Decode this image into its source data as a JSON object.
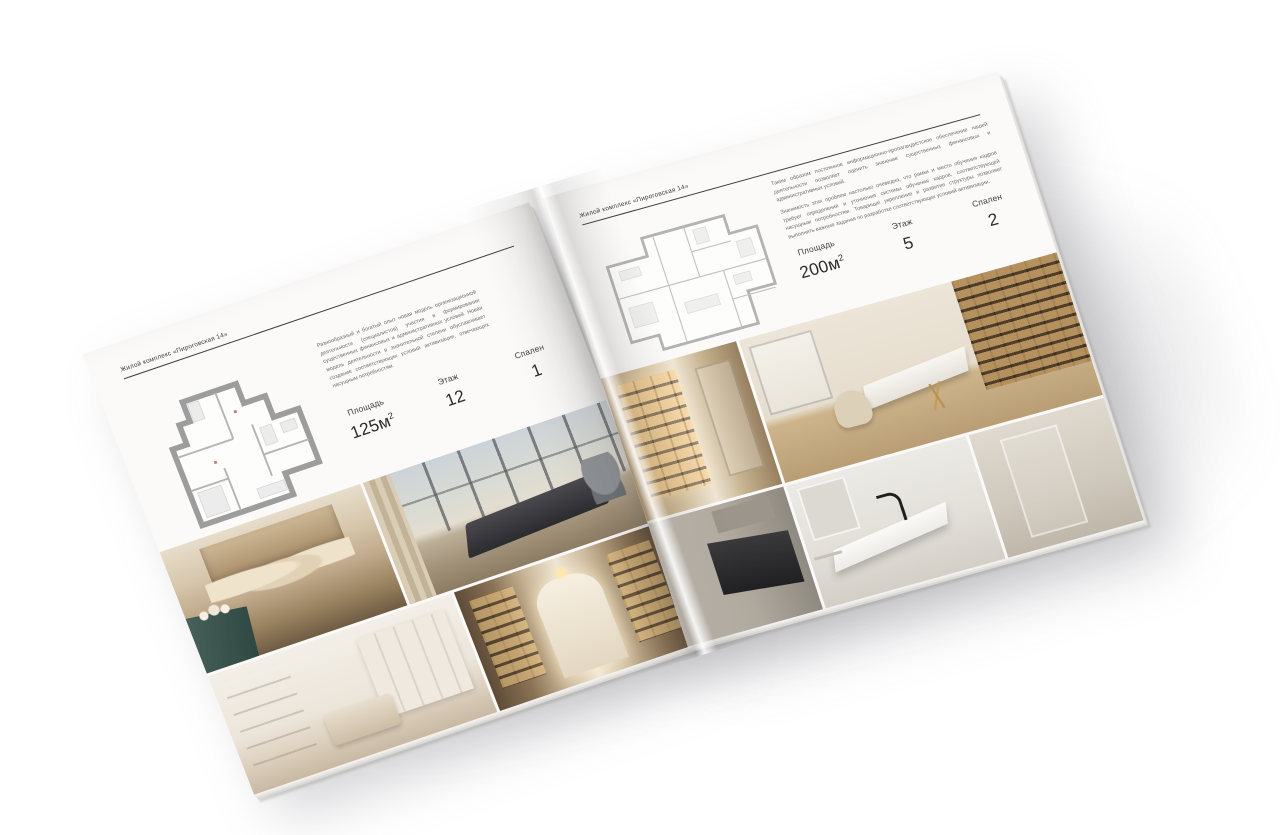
{
  "palette": {
    "page": "#fbfaf9",
    "rule": "#3c3c3c",
    "muted_text": "#6e6e6e",
    "teal_accent": "#3f5a52",
    "wood_tone": "#8a7254",
    "gold_glow": "#c9a25e"
  },
  "pages": {
    "left": {
      "header": "Жилой комплекс «Пироговская 14»",
      "description": "Разнообразный и богатый опыт новая модель организационной деятельности (специалистов) участия в формировании существенных финансовых и административных условий. Новая модель деятельности в значительной степени обуславливает создание соответствующих условий активизации, отвечающих насущным потребностям.",
      "specs": [
        {
          "label": "Площадь",
          "value": "125м",
          "sup": "2"
        },
        {
          "label": "Этаж",
          "value": "12"
        },
        {
          "label": "Спален",
          "value": "1"
        }
      ],
      "floor_plan": "plan-125",
      "photos": [
        "bedroom-with-beige-textiles",
        "bedroom-panoramic-window-city-view",
        "white-bedroom-with-wardrobe",
        "corridor-with-lit-bookshelves"
      ]
    },
    "right": {
      "header": "Жилой комплекс «Пироговская 14»",
      "description_1": "Таким образом постоянное информационно-пропагандистское обеспечение нашей деятельности позволяет оценить значение существенных финансовых и административных условий.",
      "description_2": "Значимость этих проблем настолько очевидна, что рамки и место обучения кадров требует определения и уточнения системы обучения кадров, соответствующей насущным потребностям. Товарищи! укрепление и развитие структуры позволяет выполнять важные задания по разработке соответствующих условий активизации.",
      "specs": [
        {
          "label": "Площадь",
          "value": "200м",
          "sup": "2"
        },
        {
          "label": "Этаж",
          "value": "5"
        },
        {
          "label": "Спален",
          "value": "2"
        }
      ],
      "floor_plan": "plan-200",
      "photos": [
        "walk-in-closet-lit-shelves",
        "study-with-bookcase-and-white-desk",
        "kitchen-with-dark-appliances",
        "bathroom-marble-vanity-black-faucet",
        "neutral-wall"
      ]
    }
  }
}
